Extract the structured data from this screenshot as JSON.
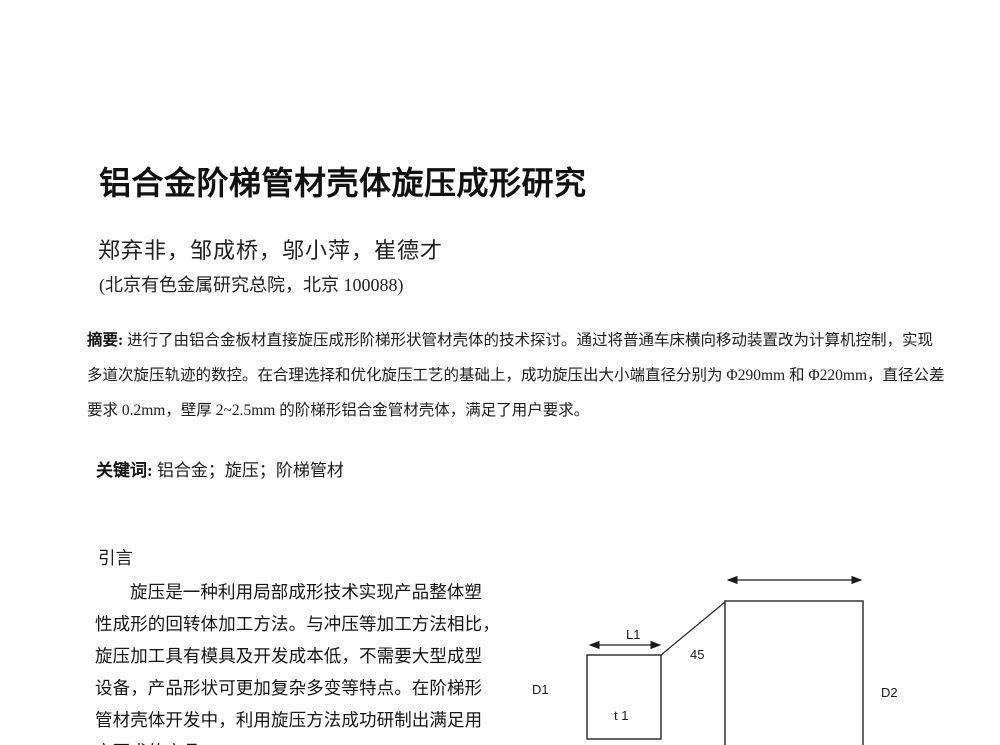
{
  "doc": {
    "title": "铝合金阶梯管材壳体旋压成形研究",
    "authors": "郑弃非，邹成桥，邬小萍，崔德才",
    "affiliation": "(北京有色金属研究总院，北京  100088)"
  },
  "abstract": {
    "label": "摘要:",
    "lines": [
      "进行了由铝合金板材直接旋压成形阶梯形状管材壳体的技术探讨。通过将普通车床横向移动装置改为计算机控制，实现",
      "多道次旋压轨迹的数控。在合理选择和优化旋压工艺的基础上，成功旋压出大小端直径分别为 Φ290mm 和 Φ220mm，直径公差",
      "要求 0.2mm，壁厚 2~2.5mm 的阶梯形铝合金管材壳体，满足了用户要求。"
    ]
  },
  "keywords": {
    "label": "关键词:",
    "text": "铝合金；旋压；阶梯管材"
  },
  "intro": {
    "heading": "引言",
    "lines": [
      "旋压是一种利用局部成形技术实现产品整体塑",
      "性成形的回转体加工方法。与冲压等加工方法相比，",
      "旋压加工具有模具及开发成本低，不需要大型成型",
      "设备，产品形状可更加复杂多变等特点。在阶梯形",
      "管材壳体开发中，利用旋压方法成功研制出满足用",
      "户要求的产品"
    ]
  },
  "figure": {
    "labels": {
      "d1": "D1",
      "l1": "L1",
      "angle": "45",
      "t1": "t 1",
      "d2": "D2"
    }
  }
}
